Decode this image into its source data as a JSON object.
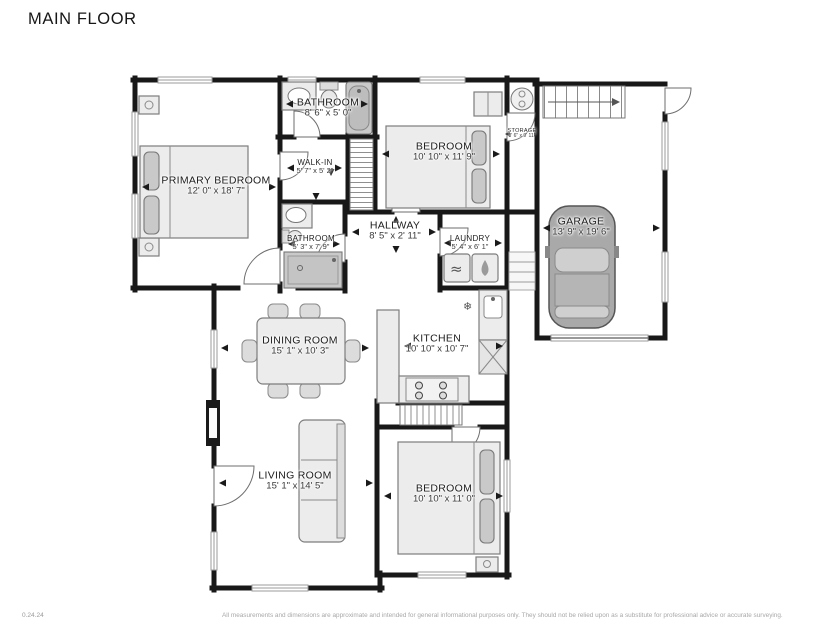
{
  "title": "MAIN FLOOR",
  "rooms": [
    {
      "id": "primary-bedroom",
      "name": "PRIMARY BEDROOM",
      "dims": "12' 0\" x 18' 7\""
    },
    {
      "id": "bathroom-top",
      "name": "BATHROOM",
      "dims": "8' 6\" x 5' 0\""
    },
    {
      "id": "walk-in",
      "name": "WALK-IN",
      "dims": "5' 7\" x 5' 2\""
    },
    {
      "id": "bathroom-hall",
      "name": "BATHROOM",
      "dims": "5' 3\" x 7' 9\""
    },
    {
      "id": "hallway",
      "name": "HALLWAY",
      "dims": "8' 5\" x 2' 11\""
    },
    {
      "id": "bedroom-top",
      "name": "BEDROOM",
      "dims": "10' 10\" x 11' 9\""
    },
    {
      "id": "storage",
      "name": "STORAGE",
      "dims": "3' 6\" x 9' 11\""
    },
    {
      "id": "laundry",
      "name": "LAUNDRY",
      "dims": "5' 4\" x 6' 1\""
    },
    {
      "id": "garage",
      "name": "GARAGE",
      "dims": "13' 9\" x 19' 6\""
    },
    {
      "id": "dining-room",
      "name": "DINING ROOM",
      "dims": "15' 1\" x 10' 3\""
    },
    {
      "id": "kitchen",
      "name": "KITCHEN",
      "dims": "10' 10\" x 10' 7\""
    },
    {
      "id": "living-room",
      "name": "LIVING ROOM",
      "dims": "15' 1\" x 14' 5\""
    },
    {
      "id": "bedroom-bottom",
      "name": "BEDROOM",
      "dims": "10' 10\" x 11' 0\""
    }
  ],
  "icons": {
    "snowflake": "❄",
    "washer_waves": "≈"
  },
  "footer": {
    "version": "0.24.24",
    "disclaimer": "All measurements and dimensions are approximate and intended for general informational purposes only. They should not be relied upon as a substitute for professional advice or accurate surveying."
  },
  "colors": {
    "wall": "#181818",
    "furniture_fill": "#ececec",
    "label": "#1c1c1c"
  }
}
